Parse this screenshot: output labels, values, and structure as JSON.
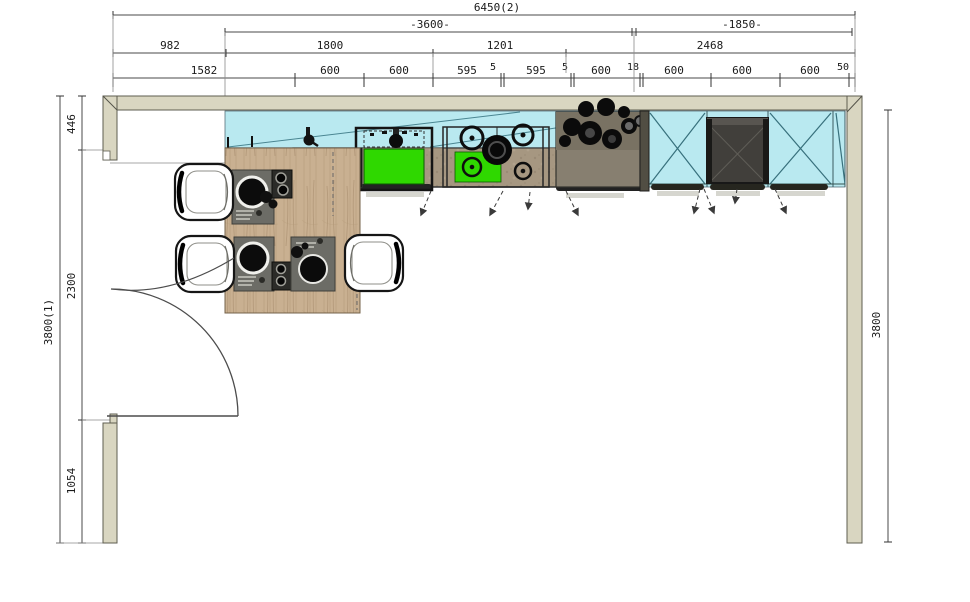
{
  "drawing": {
    "top_dims": {
      "overall": "6450(2)",
      "mid": [
        "-3600-",
        "-1850-"
      ],
      "groups": [
        "982",
        "1800",
        "1201",
        "2468"
      ],
      "segments": [
        "1582",
        "600",
        "600",
        "595",
        "5",
        "595",
        "5",
        "600",
        "18",
        "600",
        "600",
        "600",
        "50"
      ]
    },
    "left_dims": {
      "overall": "3800(1)",
      "segments": [
        "446",
        "2300",
        "1054"
      ]
    },
    "right_dims": {
      "overall": "3800"
    },
    "colors": {
      "wall": "#d9d6c1",
      "cabinet_glass": "#b9e9f0",
      "wood": "#c9b091",
      "counter": "#a69781",
      "sink_green": "#2fd800",
      "appliance": "#413f3b"
    }
  }
}
